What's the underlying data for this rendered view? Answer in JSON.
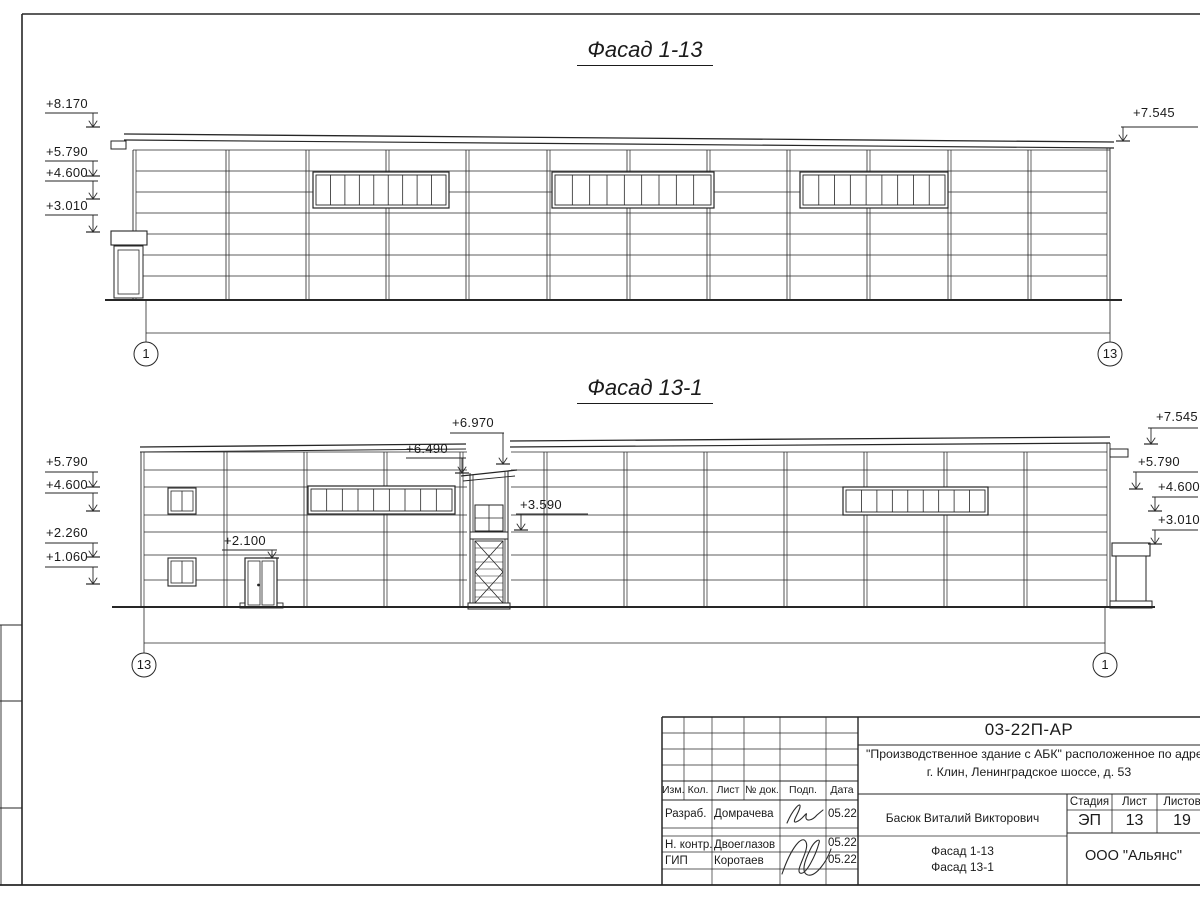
{
  "sheet": {
    "facade1": {
      "title": "Фасад 1-13",
      "marks_left": [
        "+8.170",
        "+5.790",
        "+4.600",
        "+3.010"
      ],
      "mark_right": "+7.545",
      "axis_left": "1",
      "axis_right": "13"
    },
    "facade2": {
      "title": "Фасад 13-1",
      "marks_left": [
        "+5.790",
        "+4.600",
        "+2.260",
        "+1.060"
      ],
      "marks_right": [
        "+7.545",
        "+5.790",
        "+4.600",
        "+3.010"
      ],
      "mark_tower_top": "+6.970",
      "mark_tower_roof": "+6.490",
      "mark_mid": "+3.590",
      "mark_door": "+2.100",
      "axis_left": "13",
      "axis_right": "1"
    },
    "titleblock": {
      "doc_number": "03-22П-АР",
      "project_line1": "\"Производственное здание с АБК\" расположенное по адресу:",
      "project_line2": "г. Клин, Ленинградское шоссе, д. 53",
      "rev_headers": [
        "Изм.",
        "Кол.",
        "Лист",
        "№ док.",
        "Подп.",
        "Дата"
      ],
      "signers": [
        {
          "role": "Разраб.",
          "name": "Домрачева",
          "date": "05.22"
        },
        {
          "role": "Н. контр.",
          "name": "Двоеглазов",
          "date": "05.22"
        },
        {
          "role": "ГИП",
          "name": "Коротаев",
          "date": "05.22"
        }
      ],
      "chief_name": "Басюк Виталий Викторович",
      "sheet_title1": "Фасад 1-13",
      "sheet_title2": "Фасад 13-1",
      "stage_label": "Стадия",
      "stage_value": "ЭП",
      "sheet_label": "Лист",
      "sheet_value": "13",
      "sheets_label": "Листов",
      "sheets_value": "19",
      "company": "ООО \"Альянс\""
    }
  }
}
